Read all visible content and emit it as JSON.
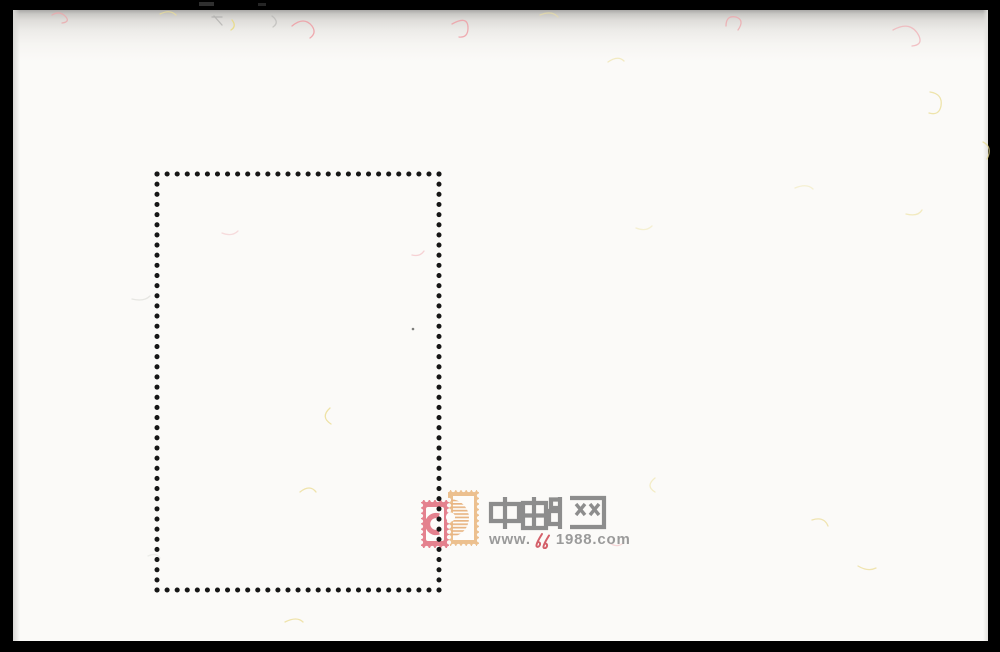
{
  "watermark": {
    "site_name": "中邮网",
    "url_prefix": "www.",
    "url_mark": "e",
    "url_suffix": "1988.com",
    "url_full": "www.e1988.com"
  },
  "colors": {
    "background": "#000000",
    "paper": "#fbfaf8",
    "dot_color": "#161616",
    "logo_gray": "#8d8d8d",
    "logo_pink": "#e4818e",
    "logo_tan": "#ecc08f",
    "url_gray": "#9a9a9a",
    "mark_red": "#d4606a"
  }
}
